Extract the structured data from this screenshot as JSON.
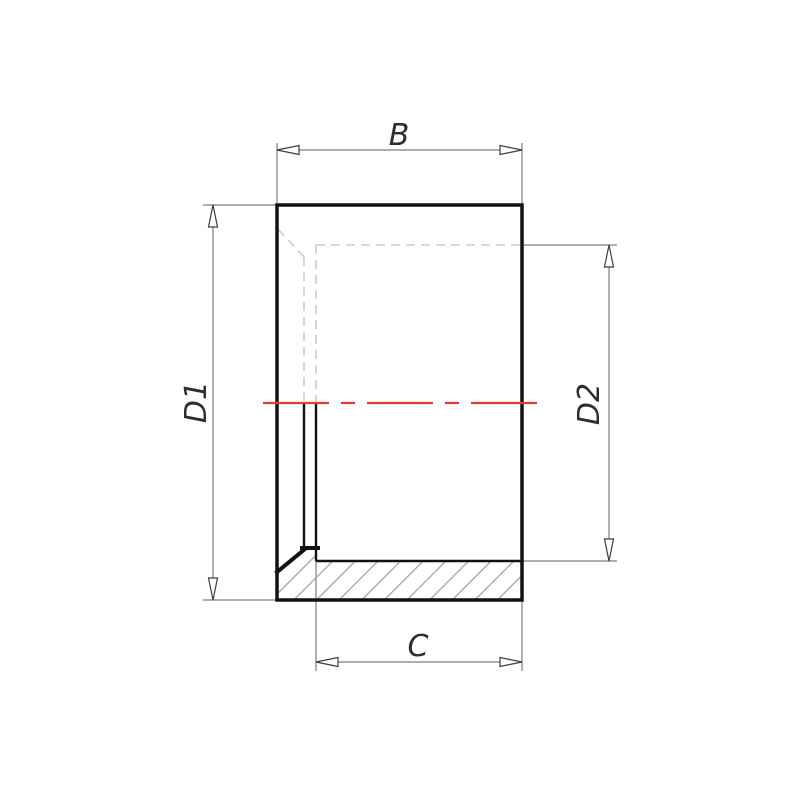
{
  "drawing": {
    "type": "technical-dimension-drawing",
    "labels": {
      "overall_length": "B",
      "outer_diameter": "D1",
      "inner_diameter": "D2",
      "socket_depth": "C"
    },
    "colors": {
      "outline": "#121212",
      "dimension_lines": "#7d7d7d",
      "hidden_lines": "#cbcbcb",
      "centerline": "#e23b3b",
      "hatch": "#9c9c9c",
      "background": "#ffffff"
    }
  }
}
